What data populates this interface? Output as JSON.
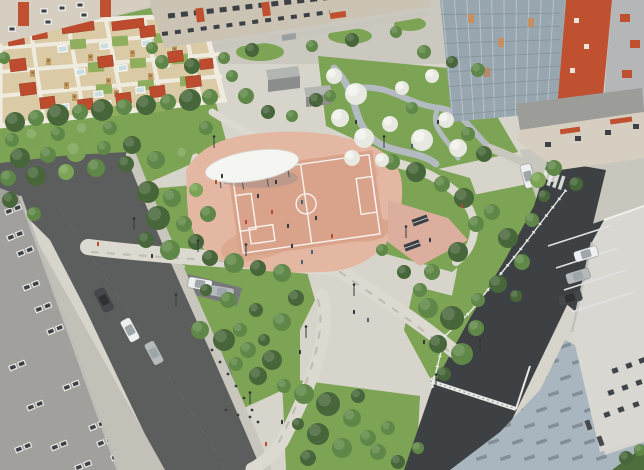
{
  "scene": {
    "description": "Aerial 3D architectural rendering of a residential courtyard park: central terracotta multi-sport court with white oval canopy, kindergarten playground grid with red shade canopies (top left), blossom garden with winding paths (top right), apartment buildings, roads with parked cars, fenced service road and paved plaza (bottom right)",
    "type": "3d-render",
    "width": 644,
    "height": 470
  },
  "colors": {
    "base": "#d7d4cb",
    "ground_top": "#cbc8c0",
    "lawn": "#7da455",
    "lawn_dark": "#5f8040",
    "g_dark": "#47663a",
    "g_mid": "#5f8747",
    "g_light": "#7ca355",
    "blossom": "#e7e8df",
    "road": "#5c5e5e",
    "road_dark": "#3d4144",
    "apron": "#c3c0b8",
    "sidewalk": "#c9c6bd",
    "path_light": "#dcd9d0",
    "path_blue": "#b3bbc0",
    "island_bay": "#77797a",
    "court_base": "#e3b7a1",
    "court_mid": "#d9a28a",
    "court_dark": "#cf9379",
    "court_line": "#ffffff",
    "plaza_pink": "#dcae9e",
    "canopy_white": "#f5f5f1",
    "canopy_shadow": "#87898c",
    "bench_dark": "#3c4044",
    "playground_base": "#dbcaa6",
    "playground_path": "#efebdf",
    "canopy_red": "#bd4c2e",
    "wood": "#c29b63",
    "sandbox": "#ccdde0",
    "lawn_cell": "#8fae5e",
    "bldg_beige": "#d6cfc1",
    "bldg_beige2": "#cbc4b4",
    "accent_red": "#bf5130",
    "window_dark": "#3d4145",
    "window_frame": "#e9e8e4",
    "glass": "#98a6af",
    "glass_frame": "#ccd3d6",
    "glass_floor": "#76848d",
    "annex_roof": "#9c9c98",
    "bldg_gray": "#a1a09c",
    "bldg_gray_edge": "#bfbdb8",
    "wall_right": "#d8d7d2",
    "pavers": "#a9b6bf",
    "paver_dark": "#5e6771",
    "fence": "#e8eae5",
    "car_white": "#edeff0",
    "car_silver": "#b7babc",
    "car_dark": "#45484b",
    "person_dark": "#33373a",
    "person_red": "#b44a31",
    "person_blue": "#46617c",
    "shed_top": "#b3b5b2",
    "shed_front": "#8c8e8d",
    "lamp": "#36393b",
    "stall_line": "#e0e3e3",
    "grass_corner": "#4f6e3e"
  },
  "objects": {
    "trees": [
      [
        15,
        122,
        10,
        "g_dark"
      ],
      [
        36,
        118,
        8,
        "g_mid"
      ],
      [
        58,
        115,
        11,
        "g_dark"
      ],
      [
        80,
        112,
        8,
        "g_mid"
      ],
      [
        102,
        110,
        11,
        "g_dark"
      ],
      [
        124,
        107,
        8,
        "g_mid"
      ],
      [
        146,
        105,
        10,
        "g_dark"
      ],
      [
        168,
        102,
        8,
        "g_mid"
      ],
      [
        190,
        100,
        11,
        "g_dark"
      ],
      [
        210,
        97,
        8,
        "g_mid"
      ],
      [
        12,
        140,
        7,
        "g_mid"
      ],
      [
        34,
        137,
        9,
        "g_light"
      ],
      [
        58,
        134,
        7,
        "g_mid"
      ],
      [
        84,
        131,
        9,
        "g_light"
      ],
      [
        110,
        128,
        7,
        "g_mid"
      ],
      [
        20,
        158,
        10,
        "g_dark"
      ],
      [
        48,
        155,
        8,
        "g_mid"
      ],
      [
        76,
        152,
        10,
        "g_light"
      ],
      [
        104,
        148,
        7,
        "g_mid"
      ],
      [
        132,
        145,
        9,
        "g_dark"
      ],
      [
        8,
        178,
        8,
        "g_mid"
      ],
      [
        36,
        176,
        10,
        "g_dark"
      ],
      [
        66,
        172,
        8,
        "g_light"
      ],
      [
        96,
        168,
        9,
        "g_mid"
      ],
      [
        126,
        164,
        8,
        "g_dark"
      ],
      [
        156,
        160,
        9,
        "g_mid"
      ],
      [
        184,
        155,
        8,
        "g_light"
      ],
      [
        10,
        200,
        8,
        "g_dark"
      ],
      [
        34,
        214,
        7,
        "g_mid"
      ],
      [
        148,
        192,
        11,
        "g_dark"
      ],
      [
        172,
        198,
        9,
        "g_mid"
      ],
      [
        158,
        218,
        12,
        "g_dark"
      ],
      [
        184,
        224,
        8,
        "g_mid"
      ],
      [
        146,
        240,
        8,
        "g_dark"
      ],
      [
        170,
        250,
        10,
        "g_mid"
      ],
      [
        196,
        242,
        8,
        "g_dark"
      ],
      [
        208,
        214,
        8,
        "g_mid"
      ],
      [
        196,
        190,
        7,
        "g_light"
      ],
      [
        210,
        258,
        8,
        "g_dark"
      ],
      [
        234,
        263,
        10,
        "g_mid"
      ],
      [
        258,
        268,
        8,
        "g_dark"
      ],
      [
        282,
        273,
        9,
        "g_mid"
      ],
      [
        296,
        298,
        8,
        "g_dark"
      ],
      [
        282,
        322,
        9,
        "g_mid"
      ],
      [
        256,
        310,
        7,
        "g_dark"
      ],
      [
        228,
        300,
        8,
        "g_mid"
      ],
      [
        206,
        290,
        6,
        "g_dark"
      ],
      [
        240,
        330,
        7,
        "g_mid"
      ],
      [
        264,
        340,
        6,
        "g_dark"
      ],
      [
        200,
        330,
        9,
        "g_mid"
      ],
      [
        224,
        340,
        11,
        "g_dark"
      ],
      [
        248,
        350,
        8,
        "g_mid"
      ],
      [
        272,
        360,
        10,
        "g_dark"
      ],
      [
        236,
        364,
        7,
        "g_mid"
      ],
      [
        258,
        376,
        9,
        "g_dark"
      ],
      [
        284,
        386,
        7,
        "g_mid"
      ],
      [
        304,
        394,
        10,
        "g_mid"
      ],
      [
        328,
        404,
        12,
        "g_dark"
      ],
      [
        352,
        418,
        9,
        "g_mid"
      ],
      [
        318,
        434,
        11,
        "g_dark"
      ],
      [
        342,
        448,
        10,
        "g_mid"
      ],
      [
        308,
        458,
        8,
        "g_dark"
      ],
      [
        368,
        438,
        8,
        "g_mid"
      ],
      [
        358,
        396,
        7,
        "g_dark"
      ],
      [
        388,
        428,
        7,
        "g_mid"
      ],
      [
        298,
        424,
        6,
        "g_dark"
      ],
      [
        428,
        308,
        10,
        "g_mid"
      ],
      [
        452,
        318,
        12,
        "g_dark"
      ],
      [
        476,
        328,
        8,
        "g_mid"
      ],
      [
        438,
        344,
        9,
        "g_dark"
      ],
      [
        462,
        354,
        11,
        "g_mid"
      ],
      [
        444,
        374,
        7,
        "g_dark"
      ],
      [
        420,
        290,
        7,
        "g_mid"
      ],
      [
        392,
        162,
        8,
        "g_mid"
      ],
      [
        416,
        172,
        10,
        "g_dark"
      ],
      [
        442,
        184,
        8,
        "g_mid"
      ],
      [
        464,
        198,
        10,
        "g_dark"
      ],
      [
        476,
        224,
        8,
        "g_mid"
      ],
      [
        458,
        252,
        10,
        "g_dark"
      ],
      [
        432,
        272,
        8,
        "g_mid"
      ],
      [
        404,
        272,
        7,
        "g_dark"
      ],
      [
        382,
        250,
        6,
        "g_mid"
      ],
      [
        334,
        76,
        8,
        "blossom"
      ],
      [
        356,
        94,
        11,
        "blossom"
      ],
      [
        340,
        118,
        9,
        "blossom"
      ],
      [
        364,
        138,
        10,
        "blossom"
      ],
      [
        390,
        124,
        8,
        "blossom"
      ],
      [
        402,
        88,
        7,
        "blossom"
      ],
      [
        422,
        140,
        11,
        "blossom"
      ],
      [
        446,
        120,
        8,
        "blossom"
      ],
      [
        432,
        76,
        7,
        "blossom"
      ],
      [
        458,
        148,
        9,
        "blossom"
      ],
      [
        352,
        158,
        8,
        "blossom"
      ],
      [
        382,
        160,
        7,
        "blossom"
      ],
      [
        330,
        96,
        6,
        "g_mid"
      ],
      [
        412,
        108,
        6,
        "g_mid"
      ],
      [
        468,
        134,
        7,
        "g_mid"
      ],
      [
        484,
        154,
        8,
        "g_dark"
      ],
      [
        246,
        96,
        8,
        "g_mid"
      ],
      [
        268,
        112,
        7,
        "g_dark"
      ],
      [
        292,
        116,
        6,
        "g_mid"
      ],
      [
        316,
        100,
        7,
        "g_dark"
      ],
      [
        232,
        76,
        6,
        "g_mid"
      ],
      [
        206,
        128,
        7,
        "g_mid"
      ],
      [
        162,
        62,
        7,
        "g_mid"
      ],
      [
        192,
        66,
        8,
        "g_dark"
      ],
      [
        224,
        58,
        6,
        "g_mid"
      ],
      [
        252,
        50,
        7,
        "g_dark"
      ],
      [
        312,
        46,
        6,
        "g_mid"
      ],
      [
        352,
        40,
        7,
        "g_dark"
      ],
      [
        396,
        32,
        6,
        "g_mid"
      ],
      [
        424,
        52,
        7,
        "g_mid"
      ],
      [
        452,
        62,
        6,
        "g_dark"
      ],
      [
        478,
        70,
        7,
        "g_mid"
      ],
      [
        492,
        212,
        8,
        "g_mid"
      ],
      [
        508,
        238,
        10,
        "g_dark"
      ],
      [
        522,
        262,
        8,
        "g_mid"
      ],
      [
        498,
        284,
        9,
        "g_dark"
      ],
      [
        478,
        300,
        7,
        "g_mid"
      ],
      [
        516,
        296,
        6,
        "g_dark"
      ],
      [
        532,
        220,
        7,
        "g_mid"
      ],
      [
        544,
        196,
        6,
        "g_dark"
      ],
      [
        378,
        452,
        8,
        "g_mid"
      ],
      [
        398,
        462,
        7,
        "g_dark"
      ],
      [
        418,
        448,
        6,
        "g_mid"
      ],
      [
        554,
        168,
        8,
        "g_mid"
      ],
      [
        576,
        184,
        7,
        "g_dark"
      ],
      [
        538,
        180,
        8,
        "g_light"
      ],
      [
        626,
        458,
        7,
        "g_dark"
      ],
      [
        640,
        450,
        6,
        "g_mid"
      ],
      [
        4,
        58,
        6,
        "g_mid"
      ],
      [
        152,
        48,
        6,
        "g_mid"
      ]
    ],
    "people": [
      [
        258,
        196,
        "person_dark"
      ],
      [
        272,
        212,
        "person_red"
      ],
      [
        288,
        226,
        "person_dark"
      ],
      [
        302,
        202,
        "person_blue"
      ],
      [
        316,
        218,
        "person_dark"
      ],
      [
        332,
        236,
        "person_red"
      ],
      [
        292,
        246,
        "person_dark"
      ],
      [
        312,
        252,
        "person_blue"
      ],
      [
        276,
        182,
        "person_dark"
      ],
      [
        246,
        222,
        "person_red"
      ],
      [
        222,
        176,
        "person_dark"
      ],
      [
        216,
        182,
        "person_red"
      ],
      [
        354,
        312,
        "person_dark"
      ],
      [
        368,
        320,
        "person_blue"
      ],
      [
        300,
        352,
        "person_dark"
      ],
      [
        282,
        422,
        "person_dark"
      ],
      [
        266,
        444,
        "person_red"
      ],
      [
        302,
        262,
        "person_blue"
      ],
      [
        424,
        342,
        "person_dark"
      ],
      [
        152,
        256,
        "person_dark"
      ],
      [
        98,
        244,
        "person_red"
      ],
      [
        438,
        122,
        "person_dark"
      ],
      [
        412,
        146,
        "person_blue"
      ],
      [
        356,
        122,
        "person_dark"
      ],
      [
        462,
        206,
        "person_red"
      ],
      [
        430,
        240,
        "person_dark"
      ]
    ],
    "cars": [
      [
        104,
        300,
        62,
        "car_dark"
      ],
      [
        130,
        330,
        62,
        "car_white"
      ],
      [
        154,
        353,
        62,
        "car_silver"
      ],
      [
        200,
        284,
        10,
        "car_white"
      ],
      [
        222,
        292,
        10,
        "car_silver"
      ],
      [
        586,
        254,
        -17,
        "car_white"
      ],
      [
        578,
        276,
        -17,
        "car_silver"
      ],
      [
        570,
        298,
        -17,
        "car_dark"
      ],
      [
        528,
        176,
        75,
        "car_white"
      ]
    ],
    "canopies": [
      [
        8,
        33,
        16,
        12
      ],
      [
        32,
        28,
        15,
        11
      ],
      [
        140,
        26,
        15,
        11
      ],
      [
        174,
        29,
        15,
        11
      ],
      [
        62,
        23,
        32,
        9
      ],
      [
        112,
        20,
        32,
        9
      ],
      [
        188,
        19,
        26,
        8
      ],
      [
        10,
        59,
        16,
        12
      ],
      [
        98,
        56,
        15,
        11
      ],
      [
        168,
        51,
        15,
        11
      ],
      [
        20,
        83,
        16,
        12
      ],
      [
        40,
        97,
        15,
        11
      ],
      [
        78,
        99,
        15,
        11
      ],
      [
        116,
        93,
        15,
        11
      ],
      [
        150,
        86,
        15,
        11
      ],
      [
        186,
        76,
        15,
        11
      ],
      [
        200,
        59,
        13,
        10
      ]
    ],
    "wood_towers": [
      [
        46,
        58
      ],
      [
        88,
        54
      ],
      [
        130,
        50
      ],
      [
        64,
        82
      ],
      [
        106,
        78
      ],
      [
        148,
        73
      ],
      [
        30,
        70
      ],
      [
        72,
        94
      ],
      [
        114,
        90
      ],
      [
        156,
        86
      ],
      [
        82,
        106
      ],
      [
        124,
        102
      ],
      [
        166,
        98
      ],
      [
        172,
        46
      ]
    ],
    "sandboxes": [
      [
        58,
        46
      ],
      [
        100,
        43
      ],
      [
        142,
        40
      ],
      [
        76,
        69
      ],
      [
        118,
        65
      ],
      [
        160,
        61
      ],
      [
        94,
        91
      ],
      [
        136,
        87
      ],
      [
        60,
        104
      ],
      [
        102,
        101
      ],
      [
        144,
        97
      ],
      [
        184,
        37
      ]
    ],
    "lawn_cells": [
      [
        70,
        39
      ],
      [
        112,
        36
      ],
      [
        154,
        33
      ],
      [
        88,
        62
      ],
      [
        130,
        58
      ],
      [
        96,
        84
      ],
      [
        138,
        80
      ],
      [
        180,
        76
      ],
      [
        106,
        106
      ],
      [
        148,
        102
      ],
      [
        196,
        30
      ],
      [
        172,
        54
      ]
    ],
    "bollards": [
      [
        212,
        350
      ],
      [
        220,
        362
      ],
      [
        228,
        374
      ],
      [
        236,
        386
      ],
      [
        244,
        398
      ],
      [
        252,
        410
      ],
      [
        258,
        422
      ],
      [
        226,
        410
      ],
      [
        238,
        415
      ],
      [
        250,
        417
      ]
    ],
    "lamps": [
      [
        214,
        148
      ],
      [
        198,
        252
      ],
      [
        384,
        148
      ],
      [
        406,
        238
      ],
      [
        246,
        256
      ],
      [
        354,
        296
      ],
      [
        306,
        338
      ],
      [
        250,
        404
      ],
      [
        480,
        352
      ],
      [
        436,
        386
      ],
      [
        134,
        230
      ],
      [
        176,
        306
      ]
    ],
    "stalls": [
      [
        548,
        246
      ],
      [
        556,
        268
      ],
      [
        564,
        290
      ],
      [
        572,
        312
      ]
    ],
    "windows_left": [
      [
        6,
        236
      ],
      [
        22,
        286
      ],
      [
        46,
        330
      ],
      [
        8,
        366
      ],
      [
        62,
        386
      ],
      [
        26,
        406
      ],
      [
        88,
        426
      ],
      [
        50,
        446
      ],
      [
        110,
        456
      ],
      [
        14,
        448
      ],
      [
        74,
        466
      ],
      [
        34,
        308
      ],
      [
        96,
        442
      ],
      [
        4,
        210
      ],
      [
        16,
        252
      ]
    ],
    "windows_right": [
      [
        612,
        368
      ],
      [
        626,
        363
      ],
      [
        639,
        358
      ],
      [
        608,
        390
      ],
      [
        622,
        385
      ],
      [
        636,
        380
      ],
      [
        604,
        412
      ],
      [
        618,
        407
      ],
      [
        633,
        402
      ]
    ],
    "doors_right": [
      [
        586,
        420
      ],
      [
        598,
        436
      ]
    ]
  }
}
